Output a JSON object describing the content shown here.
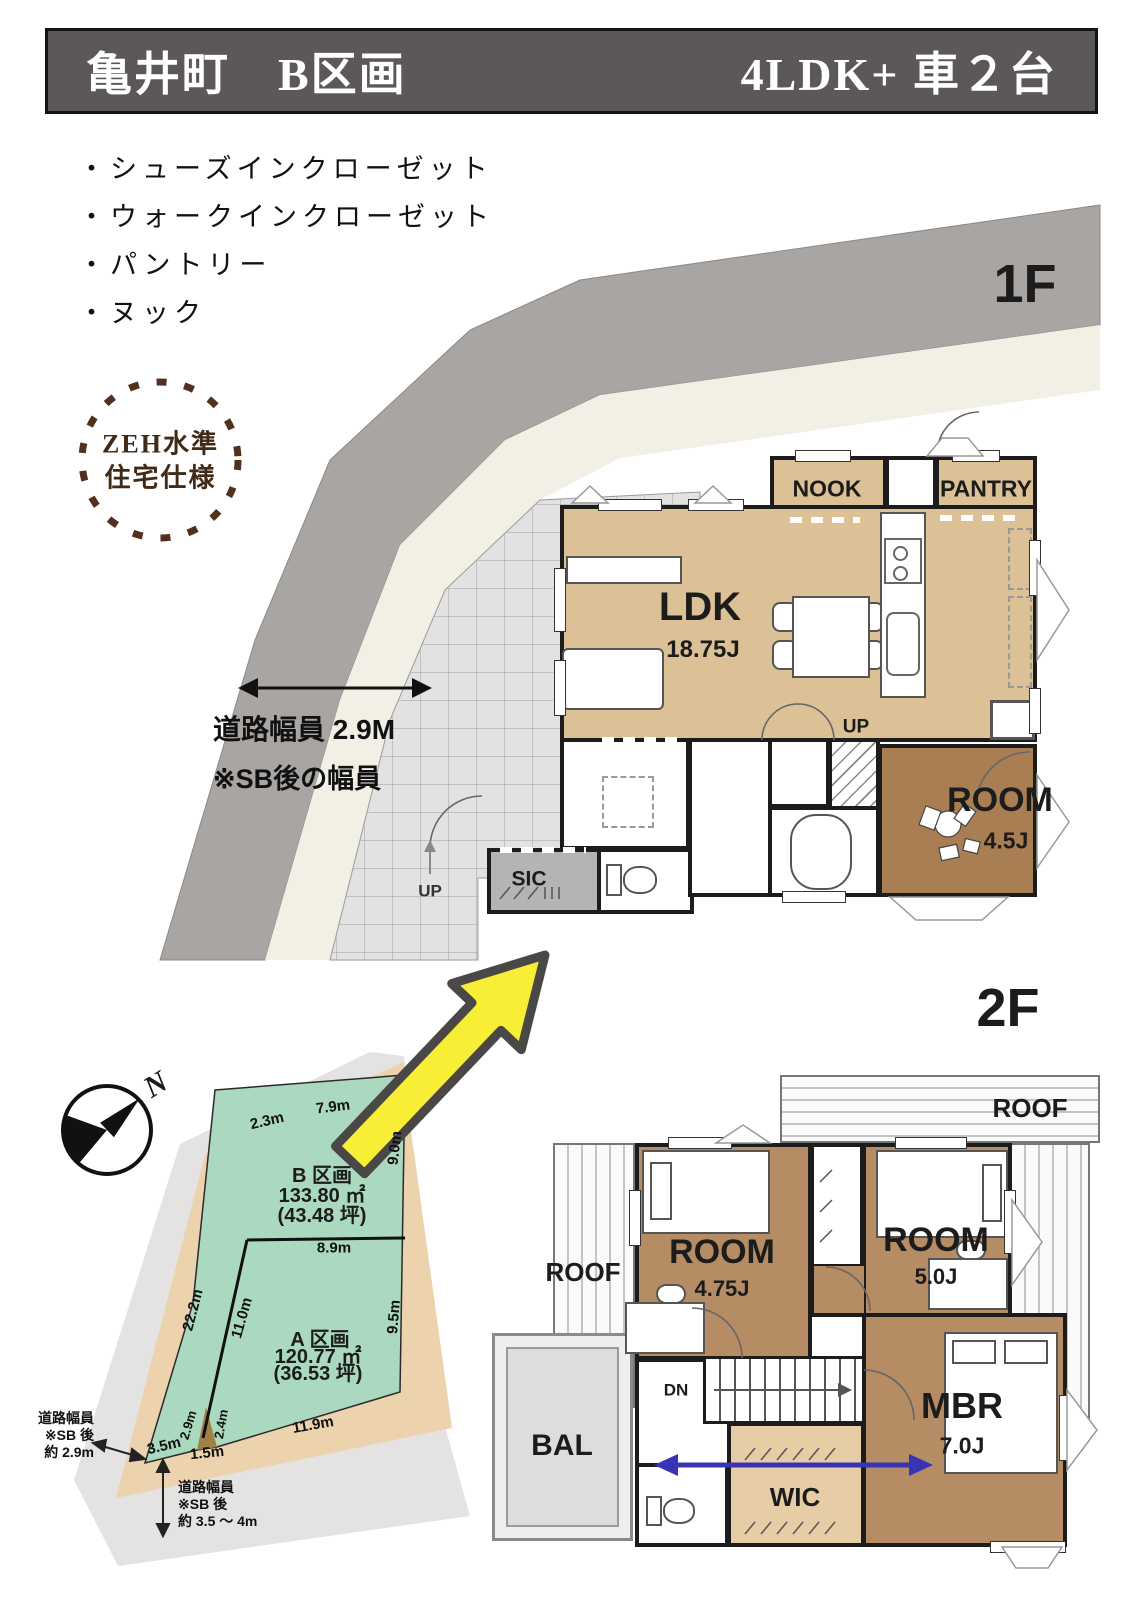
{
  "title": {
    "left": "亀井町　B区画",
    "right": "4LDK+ 車２台"
  },
  "features": {
    "bullet": "・",
    "items": [
      "シューズインクローゼット",
      "ウォークインクローゼット",
      "パントリー",
      "ヌック"
    ]
  },
  "badge": {
    "line1": "ZEH水準",
    "line2": "住宅仕様"
  },
  "floor1": {
    "label": "1F",
    "road_note": {
      "line1": "道路幅員 2.9M",
      "line2": "※SB後の幅員"
    },
    "rooms": {
      "nook": "NOOK",
      "pantry": "PANTRY",
      "ldk": "LDK",
      "ldk_size": "18.75J",
      "up": "UP",
      "sic": "SIC",
      "room": "ROOM",
      "room_size": "4.5J"
    }
  },
  "floor2": {
    "label": "2F",
    "rooms": {
      "roof_top": "ROOF",
      "roof_left": "ROOF",
      "room1": "ROOM",
      "room1_size": "4.75J",
      "room2": "ROOM",
      "room2_size": "5.0J",
      "mbr": "MBR",
      "mbr_size": "7.0J",
      "wic": "WIC",
      "bal": "BAL",
      "dn": "DN"
    }
  },
  "site": {
    "north": "N",
    "parcel_b": {
      "name": "B 区画",
      "area": "133.80 ㎡",
      "tsubo": "(43.48 坪)"
    },
    "parcel_a": {
      "name": "A 区画",
      "area": "120.77 ㎡",
      "tsubo": "(36.53 坪)"
    },
    "dims": [
      "2.3m",
      "7.9m",
      "9.0m",
      "8.9m",
      "22.2m",
      "11.0m",
      "9.5m",
      "2.9m",
      "2.4m",
      "3.5m",
      "1.5m",
      "11.9m"
    ],
    "note_left": {
      "l1": "道路幅員",
      "l2": "※SB 後",
      "l3": "約 2.9m"
    },
    "note_bottom": {
      "l1": "道路幅員",
      "l2": "※SB 後",
      "l3": "約 3.5 〜 4m"
    }
  },
  "colors": {
    "title_bg": "#5b5857",
    "road_gray": "#a8a5a2",
    "setback_cream": "#f2efe5",
    "plan_tan": "#dcc096",
    "room_brown_1f": "#a97e53",
    "room_brown_2f": "#b58c63",
    "wic_tan": "#e7cda5",
    "sic_gray": "#b4b4b4",
    "parcel_green": "#abd9c0",
    "site_beige": "#ecd2ad",
    "site_road": "#e4e3e2",
    "accent_yellow": "#f8ee35",
    "arrow_blue": "#3734b5",
    "zeh_brown": "#53301d"
  }
}
